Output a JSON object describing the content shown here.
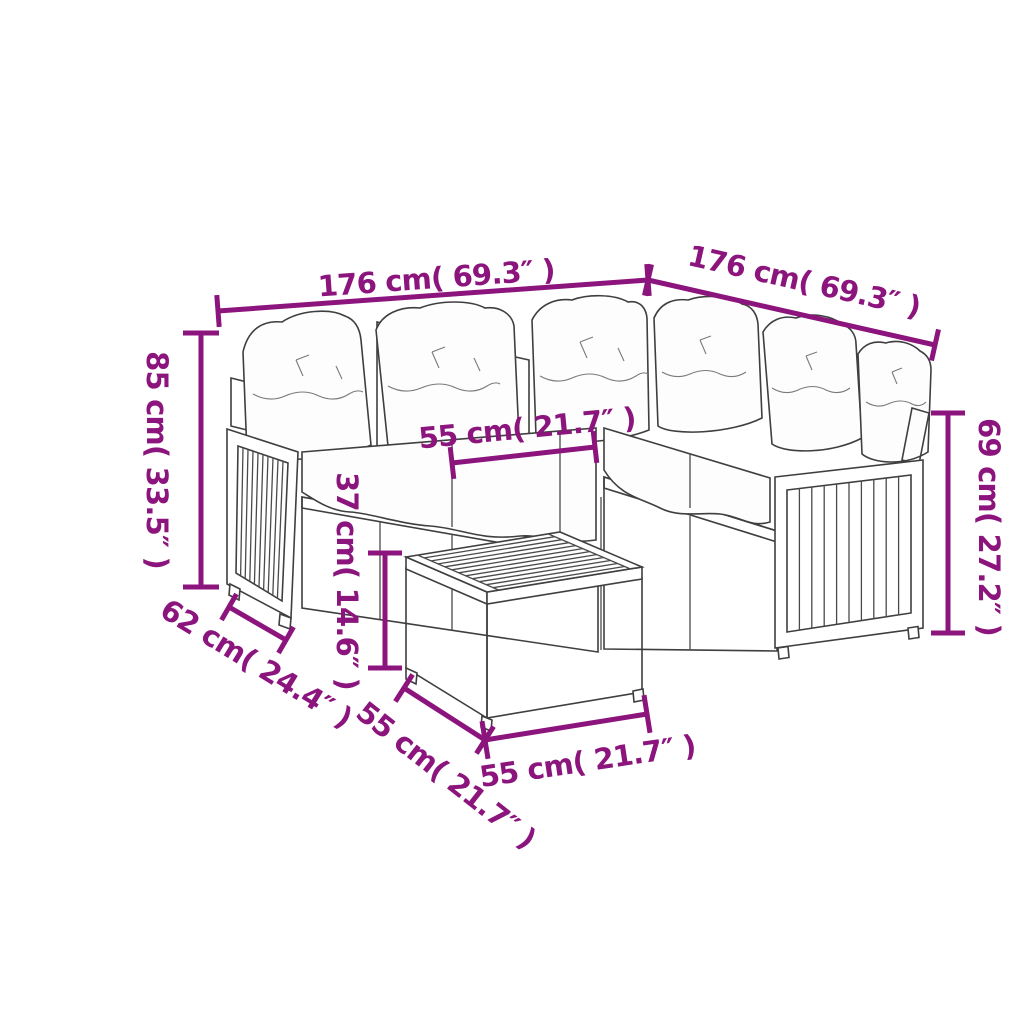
{
  "diagram": {
    "type": "product-dimension-diagram",
    "product": "garden-corner-sofa-set-with-coffee-table",
    "background_color": "#ffffff",
    "dimension_color": "#8C147D",
    "outline_color": "#3f3f3f",
    "unit_style": "cm and inches",
    "dimensions": {
      "sofa_left_width": "176 cm( 69.3″ )",
      "sofa_right_width": "176 cm( 69.3″ )",
      "backrest_height": "85 cm( 33.5″ )",
      "seat_width": "55 cm( 21.7″ )",
      "table_height": "37 cm( 14.6″ )",
      "armrest_height": "69 cm( 27.2″ )",
      "seat_depth": "62 cm( 24.4″ )",
      "table_depth": "55 cm( 21.7″ )",
      "table_width": "55 cm( 21.7″ )"
    }
  }
}
